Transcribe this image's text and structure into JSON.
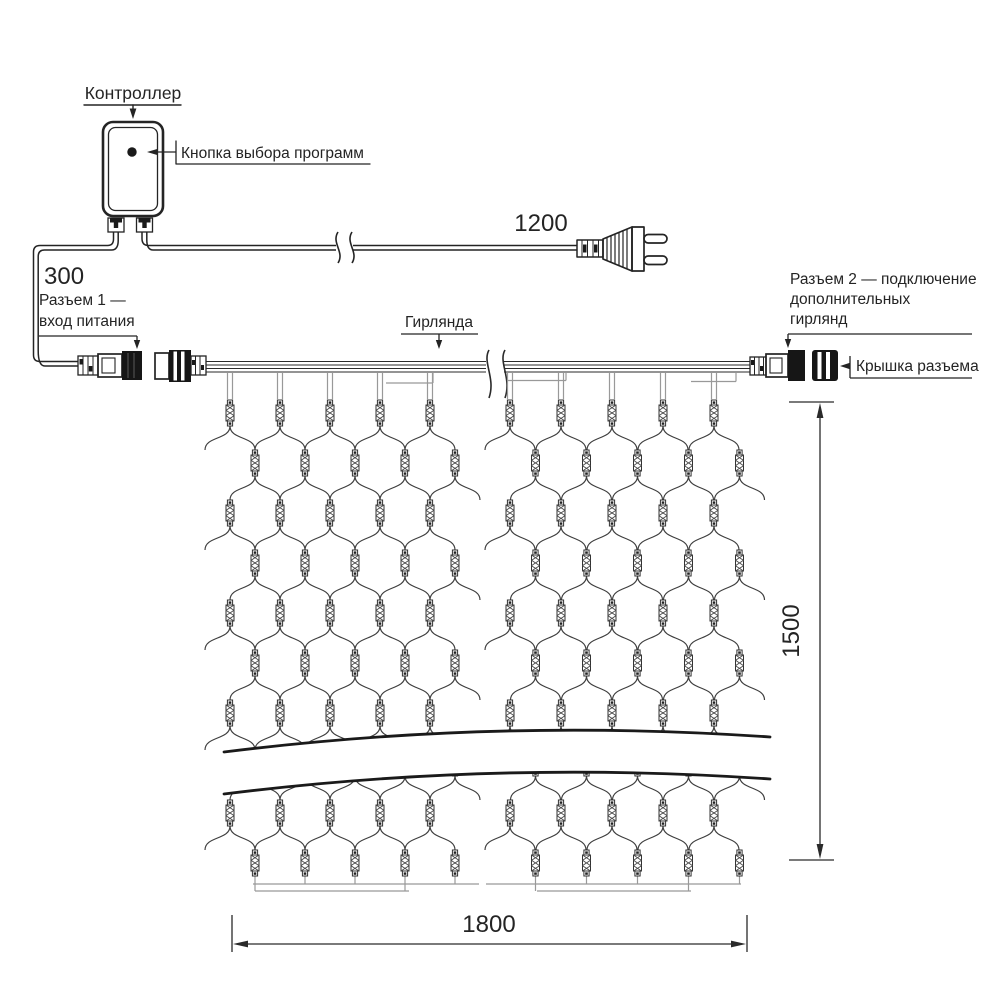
{
  "diagram": {
    "controller": {
      "label": "Контроллер",
      "button_label": "Кнопка выбора программ"
    },
    "power": {
      "cable_length": "1200"
    },
    "connector1": {
      "length": "300",
      "line1": "Разъем 1 —",
      "line2": "вход питания"
    },
    "garland": {
      "label": "Гирлянда"
    },
    "connector2": {
      "line1": "Разъем 2 — подключение",
      "line2": "дополнительных",
      "line3": "гирлянд",
      "cap_label": "Крышка разъема"
    },
    "dimensions": {
      "width": "1800",
      "height": "1500"
    },
    "colors": {
      "line": "#242424",
      "thin_wire": "#999999",
      "mesh": "#3d3d3d"
    }
  }
}
